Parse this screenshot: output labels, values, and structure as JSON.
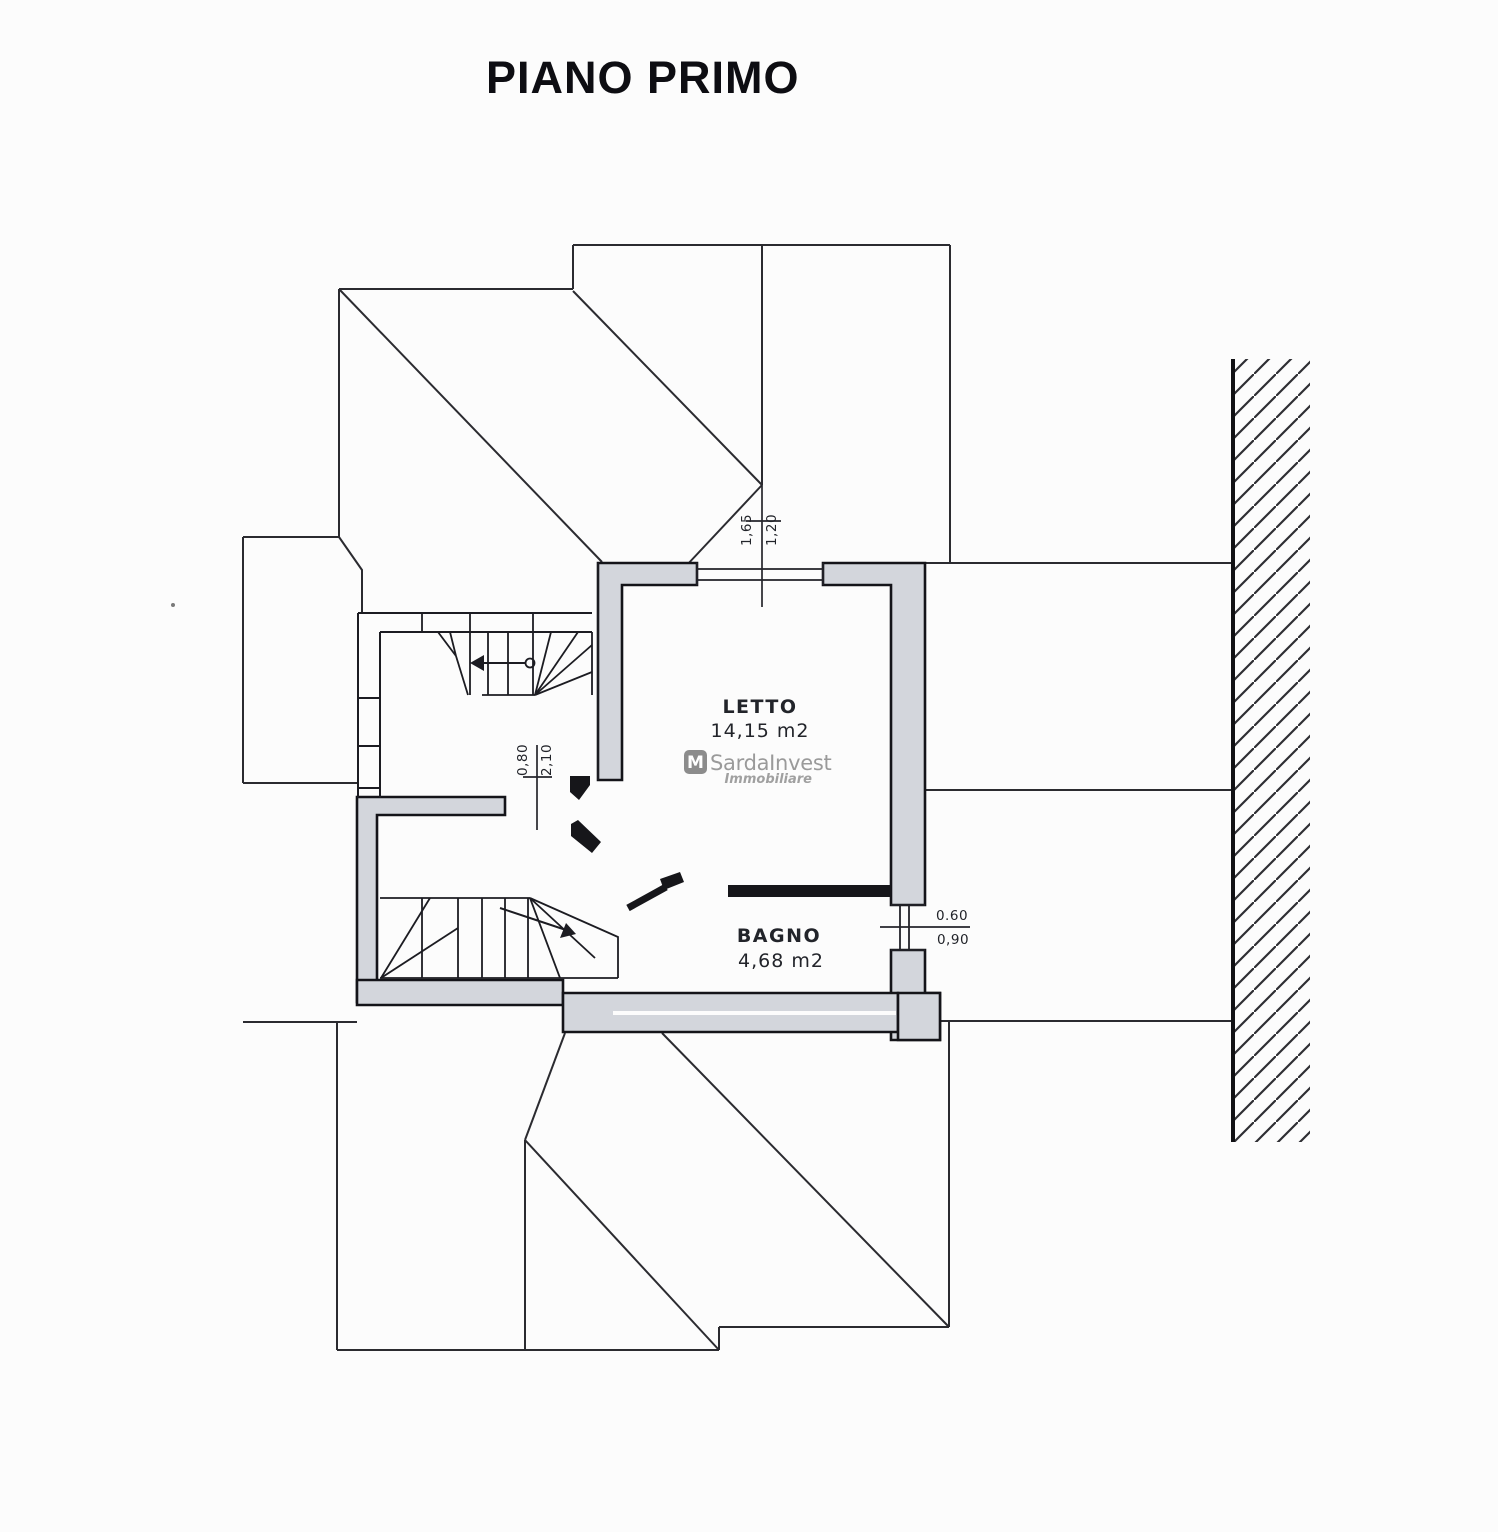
{
  "title": "PIANO PRIMO",
  "colors": {
    "paper": "#fcfcfc",
    "wall_fill": "#d3d6dc",
    "line": "#1d1d22",
    "partition_fill": "#16161a",
    "watermark_gray": "#9a9a9a"
  },
  "rooms": [
    {
      "name": "LETTO",
      "area": "14,15 m2"
    },
    {
      "name": "BAGNO",
      "area": "4,68 m2"
    }
  ],
  "dimensions": {
    "bedroom_window": {
      "width": "1,65",
      "height": "1,20"
    },
    "bedroom_door": {
      "width": "0,80",
      "height": "2,10"
    },
    "bath_window": {
      "width": "0.60",
      "height": "0,90"
    }
  },
  "watermark": {
    "icon_letter": "M",
    "name": "SardaInvest",
    "subtitle": "Immobiliare"
  }
}
